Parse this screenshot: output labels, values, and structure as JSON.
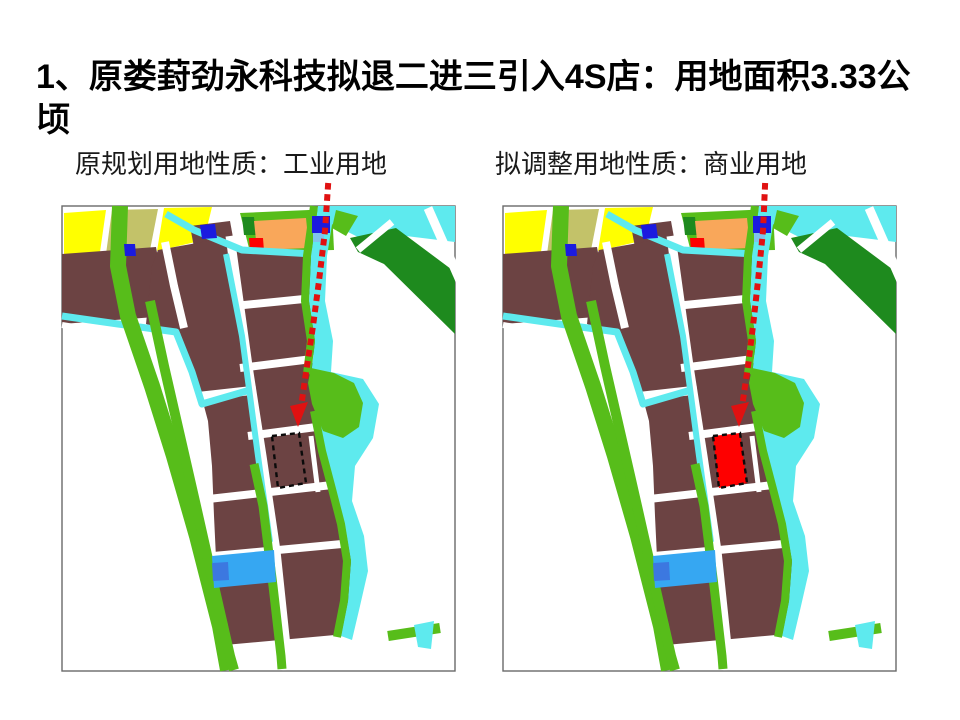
{
  "slide": {
    "title": "1、原娄葑劲永科技拟退二进三引入4S店：用地面积3.33公顷"
  },
  "maps": {
    "left": {
      "caption": "原规划用地性质：工业用地",
      "parcel_marker": "dashed-outline"
    },
    "right": {
      "caption": "拟调整用地性质：商业用地",
      "parcel_marker": "red-filled-dashed-outline"
    }
  },
  "palette": {
    "land_yellow": "#FFFF00",
    "land_olive": "#C3C269",
    "land_orange": "#F9A75A",
    "land_brown": "#6C4343",
    "green_bright": "#57BD1A",
    "green_dark": "#1E8A1E",
    "water_cyan": "#5EEAEE",
    "pond_blue": "#36A7F2",
    "pond_dark_blue": "#3C78E0",
    "block_blue": "#1B1BDF",
    "block_light_blue": "#7FC3EC",
    "mark_red": "#FE0000",
    "arrow_red": "#E01111",
    "road_white": "#FFFFFF",
    "map_border": "#6A6A6A",
    "parcel_stroke": "#0A0A0A",
    "text_color": "#000000"
  }
}
